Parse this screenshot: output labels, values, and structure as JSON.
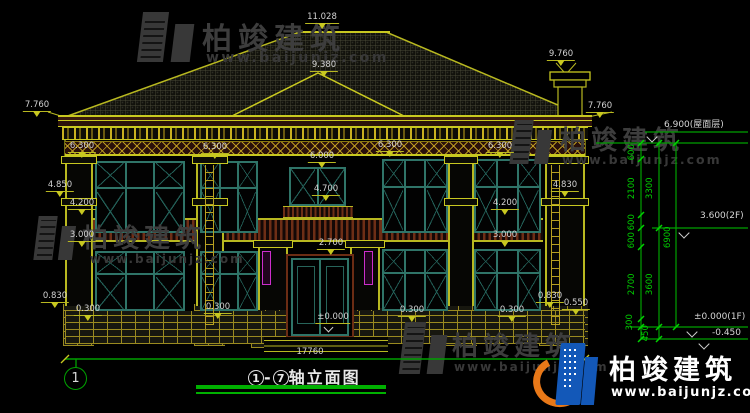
{
  "drawing": {
    "title_prefix": "1",
    "title_dash": "-",
    "title_to": "7",
    "title_text": "轴立面图",
    "axis_label": "1",
    "total_width": "17760"
  },
  "levels": {
    "ridge": "11.028",
    "gable": "9.380",
    "chimney": "9.760",
    "eave_left": "7.760",
    "eave_right": "7.760",
    "band1": "6.300",
    "band2": "6.300",
    "band3": "6.300",
    "band4": "6.300",
    "center_band": "6.000",
    "small_window": "4.700",
    "left_capital": "4.850",
    "left_window": "4.200",
    "left_rail": "3.000",
    "door_top": "2.700",
    "door_zero": "±0.000",
    "left_pier": "0.830",
    "left_sill1": "0.300",
    "left_sill2": "0.300",
    "mid_sill": "0.300",
    "right_sill": "0.300",
    "right_capital": "4.830",
    "right_window": "4.200",
    "right_rail": "3.000",
    "right_pier": "0.830",
    "right_plinth": "0.550"
  },
  "right_levels": {
    "roof": "6.900(屋面层)",
    "floor2": "3.600(2F)",
    "floor1": "±0.000(1F)",
    "ground": "-0.450"
  },
  "vdims": {
    "a": "600",
    "b": "2100",
    "c": "600",
    "d": "600",
    "e": "2700",
    "f": "300",
    "g": "450",
    "h": "3300",
    "i": "3600",
    "j": "6900"
  },
  "watermark": {
    "brand": "柏竣建筑",
    "url": "www.baijunjz.com"
  },
  "logo": {
    "brand": "柏竣建筑",
    "url": "www.baijunjz.com"
  }
}
